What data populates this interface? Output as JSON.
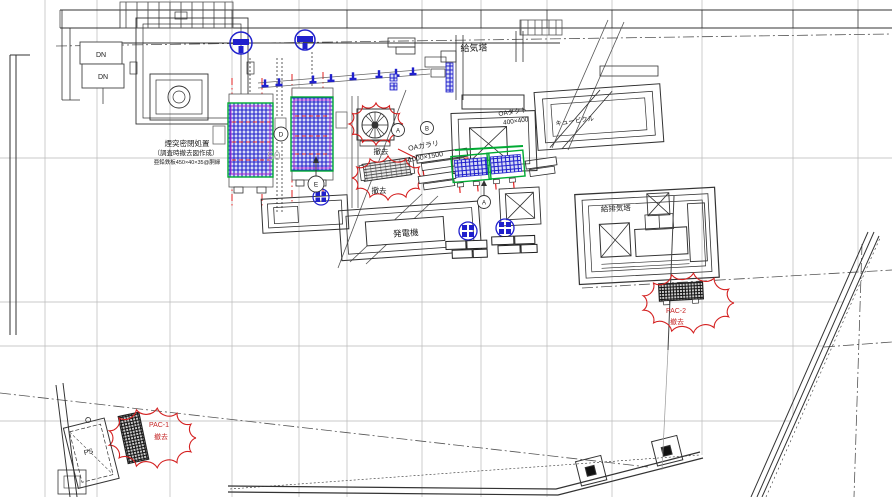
{
  "drawing": {
    "labels": {
      "chimney_note_line1": "煙突密閉処置",
      "chimney_note_line2": "（調査時撤去図作成）",
      "chimney_note_line3": "亜鉛鉄板450×40×35@胴縁",
      "supply_tower": "給気塔",
      "oa_duct_line1": "OAダクト",
      "oa_duct_line2": "400×400",
      "cubicle": "キュービクル",
      "oa_louver_line1": "OAガラリ",
      "oa_louver_line2": "1000×1500",
      "removal_fan": "撤去",
      "removal_louver": "撤去",
      "generator": "発電機",
      "supply_exhaust_tower": "給排気塔",
      "pac2_name": "PAC-2",
      "removal_pac2": "撤去",
      "pac1_name": "PAC-1",
      "removal_pac1": "撤去",
      "pipe_shaft": "PS",
      "stair_down_1": "DN",
      "stair_down_2": "DN",
      "dim_background": "50",
      "ref_bubble_1": "D",
      "ref_bubble_2": "E",
      "ref_bubble_3": "A",
      "ref_bubble_4": "B",
      "ref_bubble_5": "A"
    },
    "colors": {
      "highlight_blue": "#2020cc",
      "highlight_green": "#00aa33",
      "revision_red": "#d42020",
      "magenta": "#cc22cc",
      "line_dark": "#333333",
      "grid_gray": "#b9b9b9"
    }
  }
}
